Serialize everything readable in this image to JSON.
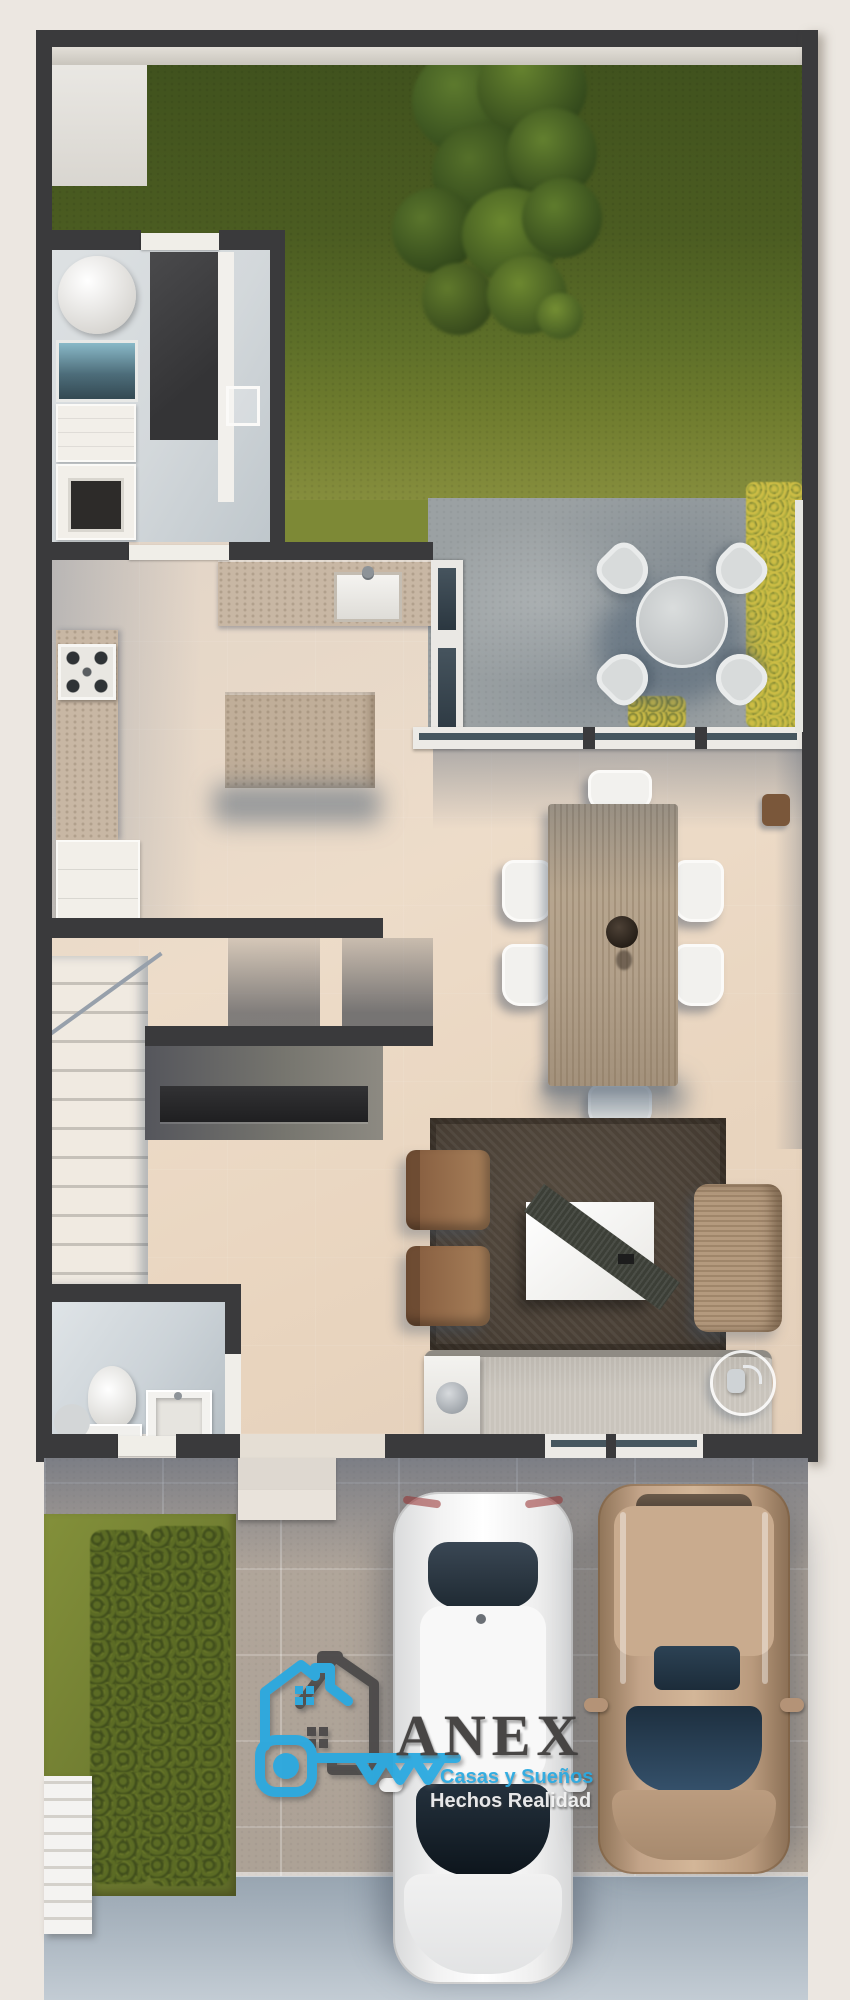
{
  "watermark": {
    "brand": "ANEX",
    "taglines": {
      "line1": "Casas y Sueños",
      "line2": "Hechos Realidad"
    },
    "icon": "house-key-logo-icon",
    "colors": {
      "blue": "#2aa9e0",
      "gray": "#4b4a48",
      "brand_text": "#3f3d3c",
      "tagline_white": "#f2f2f2"
    }
  },
  "palette": {
    "bg": "#ece7e1",
    "wall": "#3a3a3c",
    "walledge": "#e3dfd8",
    "grass1": "#3f511d",
    "grass2": "#5c6e28",
    "grass3": "#8a9140",
    "leaf": "#44601f",
    "patio": "#9ba1a3",
    "floor": "#ead9c6",
    "granite": "#c8b7a4",
    "island": "#c0ae99",
    "wood": "#b2a08a",
    "rug": "#4a4036",
    "sofa": "#c9c4bc",
    "armchair": "#8a6142",
    "rattan": "#b49a7e",
    "bath": "#ccd3d8",
    "laundry": "#d3d8db",
    "drive": "#b2a79c",
    "sidewalk": "#a6b2bd",
    "carwhite": "#f2f2f2",
    "carglass": "#22303c",
    "bronze": "#b49377",
    "bronzeglass": "#26394a",
    "logoblue": "#2aa9e0",
    "logogray": "#4b4a48",
    "brandink": "#3f3d3c"
  },
  "scene": {
    "type": "3d-floor-plan-render",
    "areas": [
      "backyard-lawn",
      "tree",
      "patio",
      "laundry-room",
      "kitchen",
      "dining-area",
      "stairs",
      "living-room",
      "half-bathroom",
      "front-garden",
      "driveway",
      "sidewalk"
    ],
    "vehicles": [
      "white-sedan",
      "bronze-suv"
    ]
  }
}
